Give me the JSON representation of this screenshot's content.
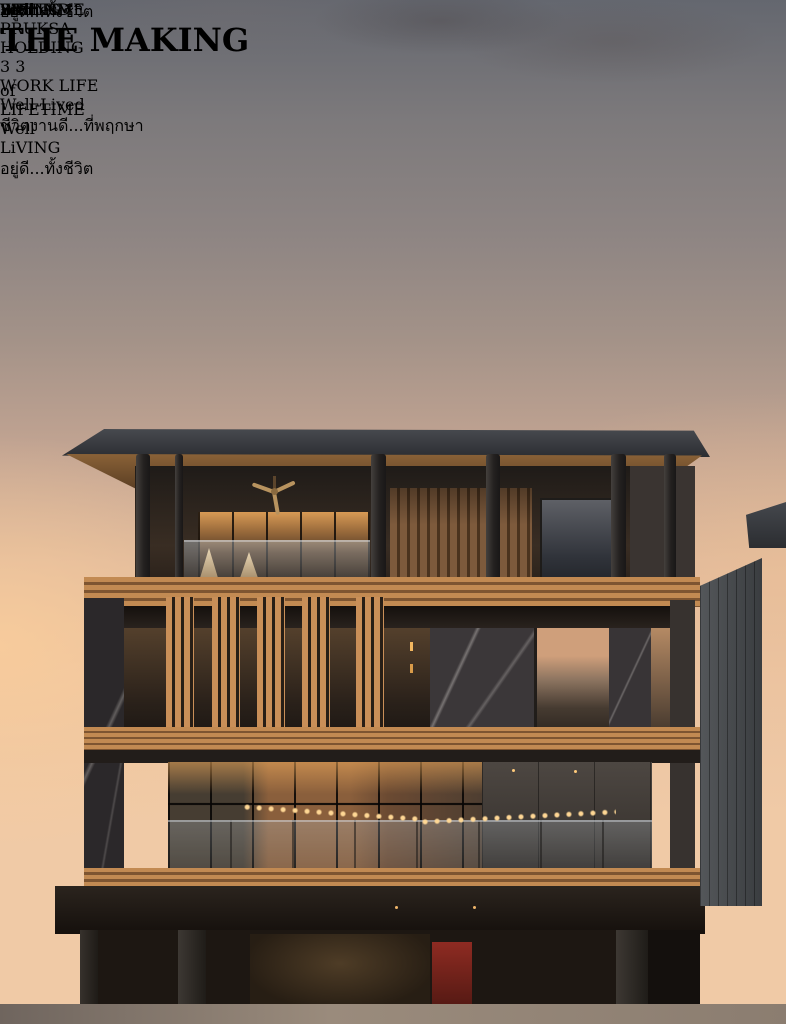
{
  "header": {
    "pruksa": {
      "monogram": "P",
      "name_line1": "PRUKSA",
      "name_line2": "HOLDING"
    },
    "anniversary": {
      "digit_front": "3",
      "digit_back": "3"
    },
    "worklife": {
      "title": "WORK LIFE",
      "script": "Well-Lived",
      "thai": "ชีวิตงานดี...ที่พฤกษา"
    }
  },
  "title": {
    "word1_initial": "T",
    "word1_rest": "HE ",
    "word2_initial": "M",
    "word2_rest": "AKING",
    "of": "of",
    "brand_line1": "LIFETIME",
    "brand_script": "Well",
    "brand_line2": "LiVING",
    "thai_tagline": "อยู่ดี...ทั้งชีวิต"
  },
  "corner": {
    "number": "33",
    "year": "Year",
    "stories": "Stories",
    "behind": "BEHIND",
    "brand_line1": "LIFETIME",
    "brand_script": "Well",
    "brand_line2": "LiVING",
    "thai_tagline": "อยู่ดี...ทั้งชีวิต"
  },
  "colors": {
    "title_gold": "#DEC06A",
    "script_green": "#74C06F",
    "behind_green": "#61A565",
    "brand_green": "#8DC63F",
    "sky_top": "#64676F",
    "sky_peach": "#ECC5A2",
    "wood": "#C28A52",
    "roof_dark": "#393B3F",
    "red_door": "#8E2B22"
  }
}
